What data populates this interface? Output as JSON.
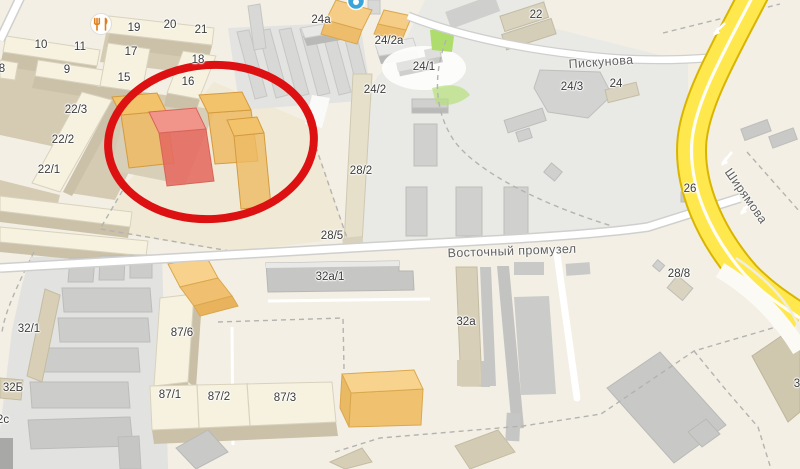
{
  "map": {
    "type": "city-map-with-annotation",
    "colors": {
      "background_beige": "#f3efe4",
      "building_cream": "#f6f2df",
      "building_tan_wall": "#cbc1a8",
      "industrial_zone_gray": "#e9e9e6",
      "warehouse_gray": "#d0d0ce",
      "road_white": "#ffffff",
      "road_yellow": "#ffe84e",
      "road_yellow_casing": "#d9b500",
      "annotation_red": "#dd1111",
      "highlight_orange": "#f0bc62",
      "highlight_red_building": "#ec7166",
      "poi_blue": "#39a5d9",
      "poi_restaurant_orange": "#e07f1d"
    },
    "labels": {
      "buildings": [
        {
          "t": "10",
          "x": 41,
          "y": 45
        },
        {
          "t": "11",
          "x": 80,
          "y": 47
        },
        {
          "t": "9",
          "x": 67,
          "y": 70
        },
        {
          "t": "8",
          "x": 2,
          "y": 69
        },
        {
          "t": "19",
          "x": 134,
          "y": 28
        },
        {
          "t": "20",
          "x": 170,
          "y": 25
        },
        {
          "t": "21",
          "x": 201,
          "y": 30
        },
        {
          "t": "17",
          "x": 131,
          "y": 52
        },
        {
          "t": "15",
          "x": 124,
          "y": 78
        },
        {
          "t": "18",
          "x": 198,
          "y": 60
        },
        {
          "t": "16",
          "x": 188,
          "y": 82
        },
        {
          "t": "22/3",
          "x": 76,
          "y": 110
        },
        {
          "t": "22/2",
          "x": 63,
          "y": 140
        },
        {
          "t": "22/1",
          "x": 49,
          "y": 170
        },
        {
          "t": "24а",
          "x": 321,
          "y": 20
        },
        {
          "t": "24/2а",
          "x": 389,
          "y": 41
        },
        {
          "t": "24/1",
          "x": 424,
          "y": 67
        },
        {
          "t": "24/2",
          "x": 375,
          "y": 90
        },
        {
          "t": "22",
          "x": 536,
          "y": 15
        },
        {
          "t": "24/3",
          "x": 572,
          "y": 87
        },
        {
          "t": "24",
          "x": 616,
          "y": 84
        },
        {
          "t": "26",
          "x": 690,
          "y": 189
        },
        {
          "t": "28/8",
          "x": 679,
          "y": 274
        },
        {
          "t": "28/2",
          "x": 361,
          "y": 171
        },
        {
          "t": "28/5",
          "x": 332,
          "y": 236
        },
        {
          "t": "32а/1",
          "x": 330,
          "y": 277
        },
        {
          "t": "32а",
          "x": 466,
          "y": 322
        },
        {
          "t": "32/1",
          "x": 29,
          "y": 329
        },
        {
          "t": "32Б",
          "x": 13,
          "y": 388
        },
        {
          "t": "2с",
          "x": 3,
          "y": 420
        },
        {
          "t": "3",
          "x": 797,
          "y": 384
        },
        {
          "t": "87/6",
          "x": 182,
          "y": 333
        },
        {
          "t": "87/1",
          "x": 170,
          "y": 395
        },
        {
          "t": "87/2",
          "x": 219,
          "y": 397
        },
        {
          "t": "87/3",
          "x": 285,
          "y": 398
        }
      ],
      "streets": [
        {
          "t": "Пискунова",
          "x": 601,
          "y": 62,
          "r": -4
        },
        {
          "t": "Восточный промузел",
          "x": 512,
          "y": 251,
          "r": -2
        },
        {
          "t": "Ширямова",
          "x": 746,
          "y": 196,
          "r": 55
        }
      ]
    },
    "icons": [
      {
        "name": "restaurant-icon",
        "glyph": "fork-and-knife",
        "x": 101,
        "y": 24
      },
      {
        "name": "poi-icon",
        "glyph": "blue-circle",
        "x": 356,
        "y": 1
      }
    ],
    "annotation": {
      "shape": "ellipse",
      "cx": 211,
      "cy": 142,
      "rx": 103,
      "ry": 77,
      "stroke_width": 8,
      "meaning": "red marker circling highlighted orange and red 3D buildings"
    }
  }
}
